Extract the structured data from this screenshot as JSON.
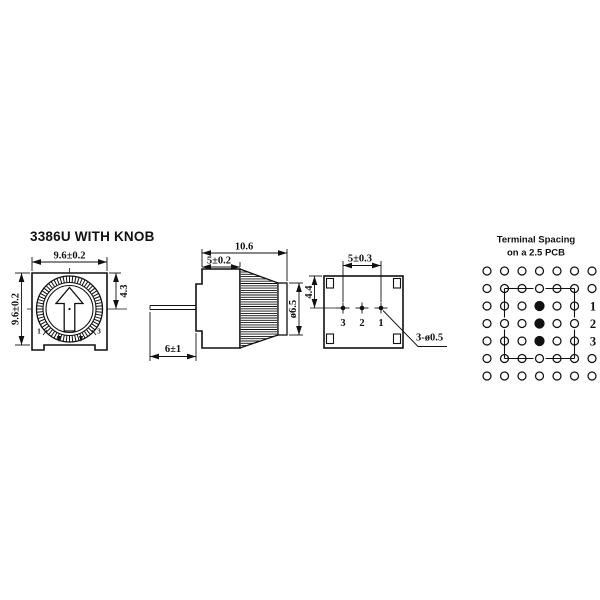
{
  "drawing": {
    "title": "3386U WITH KNOB",
    "front_view": {
      "dim_width": "9.6±0.2",
      "dim_height": "9.6±0.2",
      "dim_offset": "4.3",
      "terminal_left": "1",
      "terminal_right": "3"
    },
    "side_view": {
      "dim_overall_depth": "10.6",
      "dim_body_depth": "5±0.2",
      "dim_knob_diameter": "ø6.5",
      "dim_pin_length": "6±1"
    },
    "bottom_view": {
      "dim_terminal_span": "5±0.3",
      "dim_terminal_offset": "4.4",
      "terminal_labels": [
        "3",
        "2",
        "1"
      ],
      "hole_callout": "3-ø0.5"
    },
    "pcb": {
      "title_line1": "Terminal Spacing",
      "title_line2": "on a 2.5 PCB",
      "grid": {
        "cols": 7,
        "rows": 7,
        "filled_holes": [
          [
            4,
            3
          ],
          [
            4,
            4
          ],
          [
            4,
            5
          ]
        ],
        "label_col": 7,
        "row_labels": [
          {
            "row": 3,
            "label": "1"
          },
          {
            "row": 4,
            "label": "2"
          },
          {
            "row": 5,
            "label": "3"
          }
        ]
      }
    },
    "colors": {
      "ink": "#111111",
      "background": "#ffffff"
    }
  }
}
